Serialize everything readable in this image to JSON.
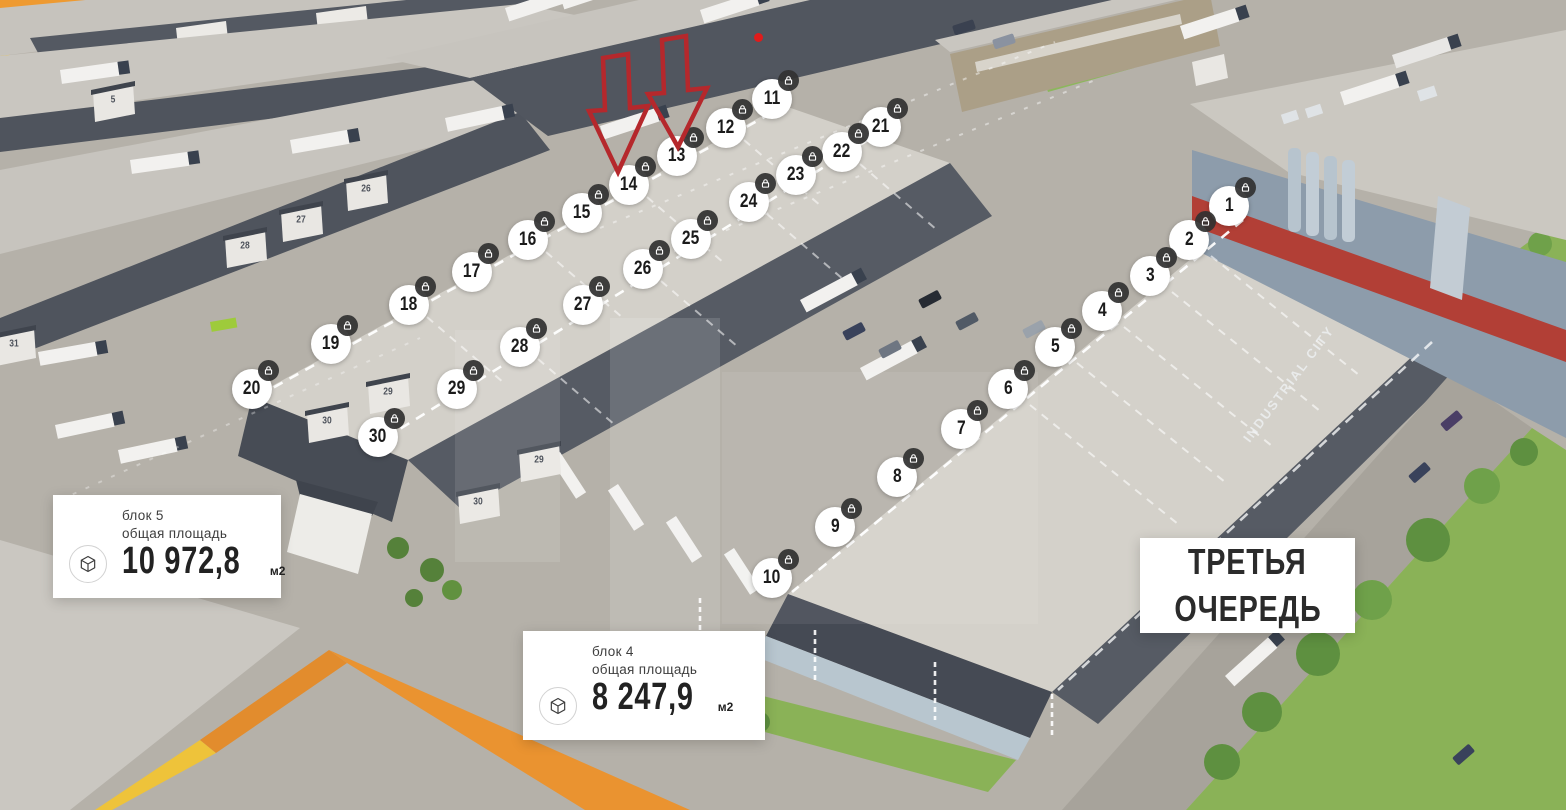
{
  "scene": {
    "facade_sign": "INDUSTRIAL CITY",
    "wall_numbers": [
      {
        "t": "5",
        "x": 113,
        "y": 100
      },
      {
        "t": "26",
        "x": 366,
        "y": 189
      },
      {
        "t": "27",
        "x": 301,
        "y": 220
      },
      {
        "t": "28",
        "x": 245,
        "y": 246
      },
      {
        "t": "31",
        "x": 14,
        "y": 344
      },
      {
        "t": "30",
        "x": 327,
        "y": 421
      },
      {
        "t": "29",
        "x": 388,
        "y": 392
      },
      {
        "t": "29",
        "x": 539,
        "y": 460
      },
      {
        "t": "30",
        "x": 478,
        "y": 502
      }
    ]
  },
  "markers": {
    "badge_icon": "lock-icon",
    "items": [
      {
        "n": "1",
        "x": 1229,
        "y": 206
      },
      {
        "n": "2",
        "x": 1189,
        "y": 240
      },
      {
        "n": "3",
        "x": 1150,
        "y": 276
      },
      {
        "n": "4",
        "x": 1102,
        "y": 311
      },
      {
        "n": "5",
        "x": 1055,
        "y": 347
      },
      {
        "n": "6",
        "x": 1008,
        "y": 389
      },
      {
        "n": "7",
        "x": 961,
        "y": 429
      },
      {
        "n": "8",
        "x": 897,
        "y": 477
      },
      {
        "n": "9",
        "x": 835,
        "y": 527
      },
      {
        "n": "10",
        "x": 772,
        "y": 578
      },
      {
        "n": "11",
        "x": 772,
        "y": 99
      },
      {
        "n": "12",
        "x": 726,
        "y": 128
      },
      {
        "n": "13",
        "x": 677,
        "y": 156
      },
      {
        "n": "14",
        "x": 629,
        "y": 185
      },
      {
        "n": "15",
        "x": 582,
        "y": 213
      },
      {
        "n": "16",
        "x": 528,
        "y": 240
      },
      {
        "n": "17",
        "x": 472,
        "y": 272
      },
      {
        "n": "18",
        "x": 409,
        "y": 305
      },
      {
        "n": "19",
        "x": 331,
        "y": 344
      },
      {
        "n": "20",
        "x": 252,
        "y": 389
      },
      {
        "n": "21",
        "x": 881,
        "y": 127
      },
      {
        "n": "22",
        "x": 842,
        "y": 152
      },
      {
        "n": "23",
        "x": 796,
        "y": 175
      },
      {
        "n": "24",
        "x": 749,
        "y": 202
      },
      {
        "n": "25",
        "x": 691,
        "y": 239
      },
      {
        "n": "26",
        "x": 643,
        "y": 269
      },
      {
        "n": "27",
        "x": 583,
        "y": 305
      },
      {
        "n": "28",
        "x": 520,
        "y": 347
      },
      {
        "n": "29",
        "x": 457,
        "y": 389
      },
      {
        "n": "30",
        "x": 378,
        "y": 437
      }
    ]
  },
  "cards": {
    "block5": {
      "title": "блок 5",
      "subtitle": "общая площадь",
      "value": "10 972,8",
      "unit": "м2"
    },
    "block4": {
      "title": "блок 4",
      "subtitle": "общая площадь",
      "value": "8 247,9",
      "unit": "м2"
    }
  },
  "phase_label": {
    "line1": "ТРЕТЬЯ",
    "line2": "ОЧЕРЕДЬ"
  },
  "annotations": {
    "arrow_color": "#b5282c",
    "arrows_point_to": [
      "13",
      "14"
    ],
    "dot_color": "#e01b1b"
  }
}
